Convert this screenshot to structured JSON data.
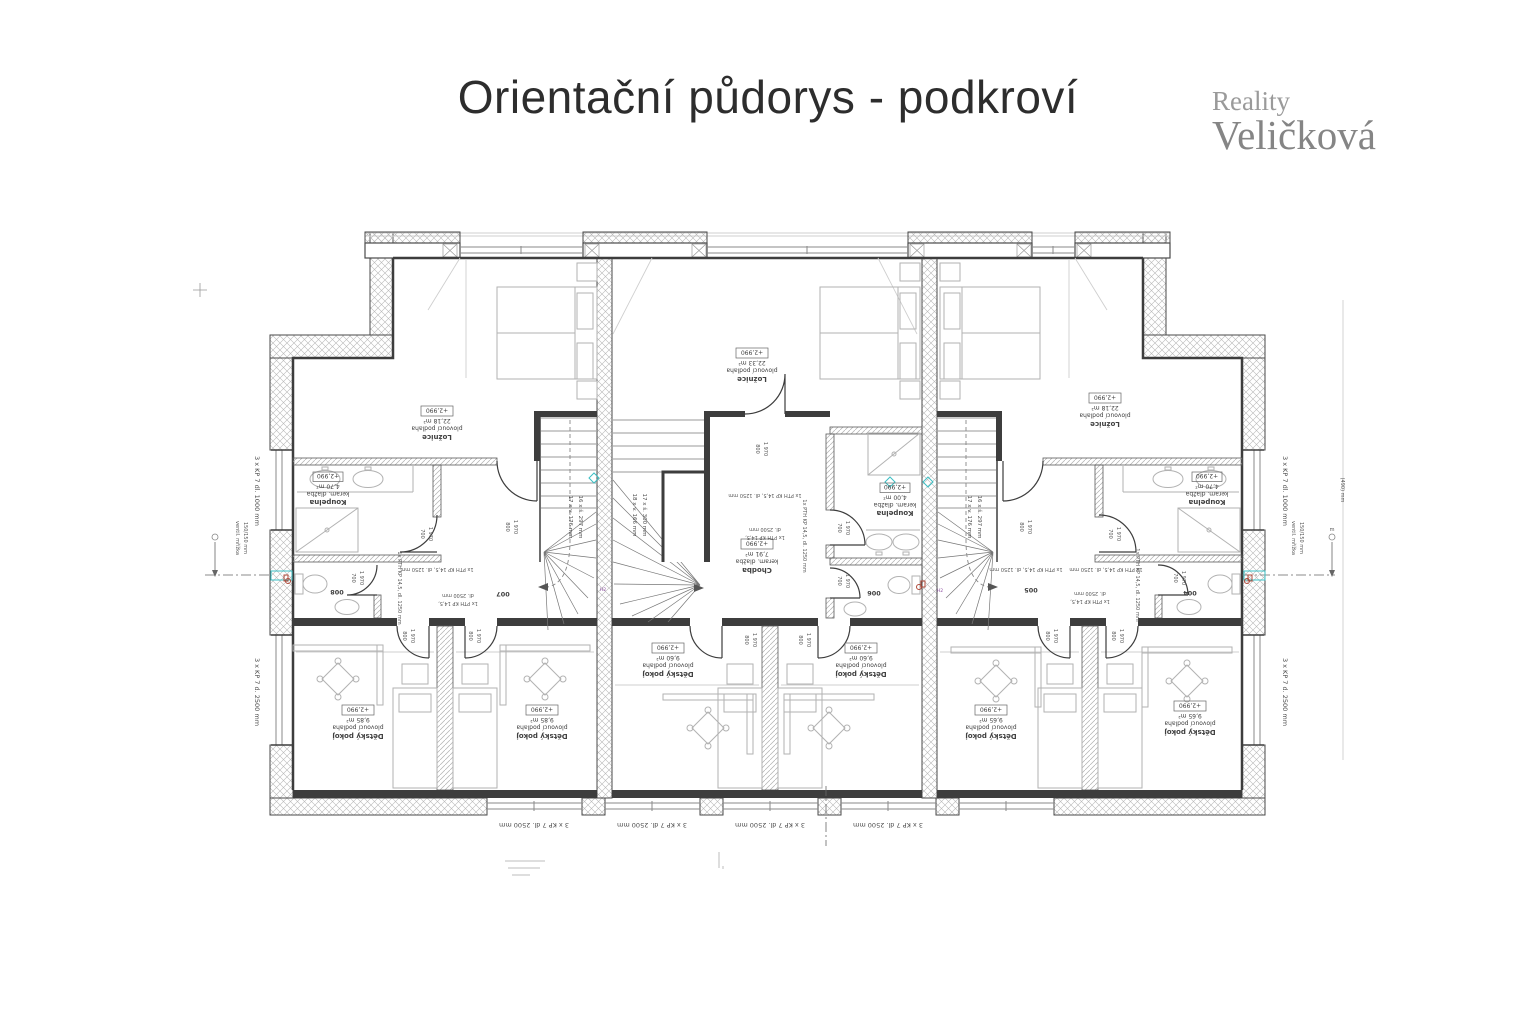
{
  "header": {
    "title": "Orientační půdorys - podkroví"
  },
  "logo": {
    "line1": "Reality",
    "line2": "Veličková"
  },
  "rooms": {
    "loznice": "Ložnice",
    "koupelna": "Koupelna",
    "chodba": "Chodba",
    "detsky_pokoj": "Dětský pokoj",
    "floor_wood": "plovoucí podlaha",
    "floor_tile": "keram. dlažba",
    "level": "+2,990",
    "areas": {
      "loznice_left": "22,18 m²",
      "loznice_center": "22,33 m²",
      "loznice_right": "22,18 m²",
      "koupelna_left": "4,70 m²",
      "koupelna_center": "4,00 m²",
      "koupelna_right": "4,70 m²",
      "chodba_center": "7,91 m²",
      "detsky_left": "9,85 m²",
      "detsky_center": "9,60 m²",
      "detsky_right": "9,65 m²"
    },
    "numbers": {
      "wc_left": "008",
      "hall_left": "007",
      "wc_center": "006",
      "hall_right": "005",
      "wc_right": "004"
    }
  },
  "stairs": {
    "left_rise": "17 x v. 176 mm",
    "left_run": "16 x š. 297 mm",
    "center_rise": "18 x v. 166 mm",
    "center_run": "17 x š. 300 mm",
    "right_rise": "17 x v. 176 mm",
    "right_run": "16 x š. 297 mm"
  },
  "dims": {
    "window_bottom": "3 x KP 7 dl. 2500 mm",
    "window_side_top": "3 x KP 7 dl. 1000 mm",
    "window_side_bottom": "3 x KP 7 d. 2500 mm",
    "vent_line1": "ventil. mřížka",
    "vent_line2": "150/150 mm",
    "level_mark": "(490) mm",
    "door_w_800": "800",
    "door_w_700": "700",
    "door_h_1970": "1 970",
    "lintel_1250": "1x PTH KP 14,5, dl. 1250 mm",
    "lintel_2500_l1": "1x PTH KP 14,5,",
    "lintel_2500_l2": "dl. 2500 mm",
    "mark_h2": "H2",
    "mark_m": "m"
  }
}
